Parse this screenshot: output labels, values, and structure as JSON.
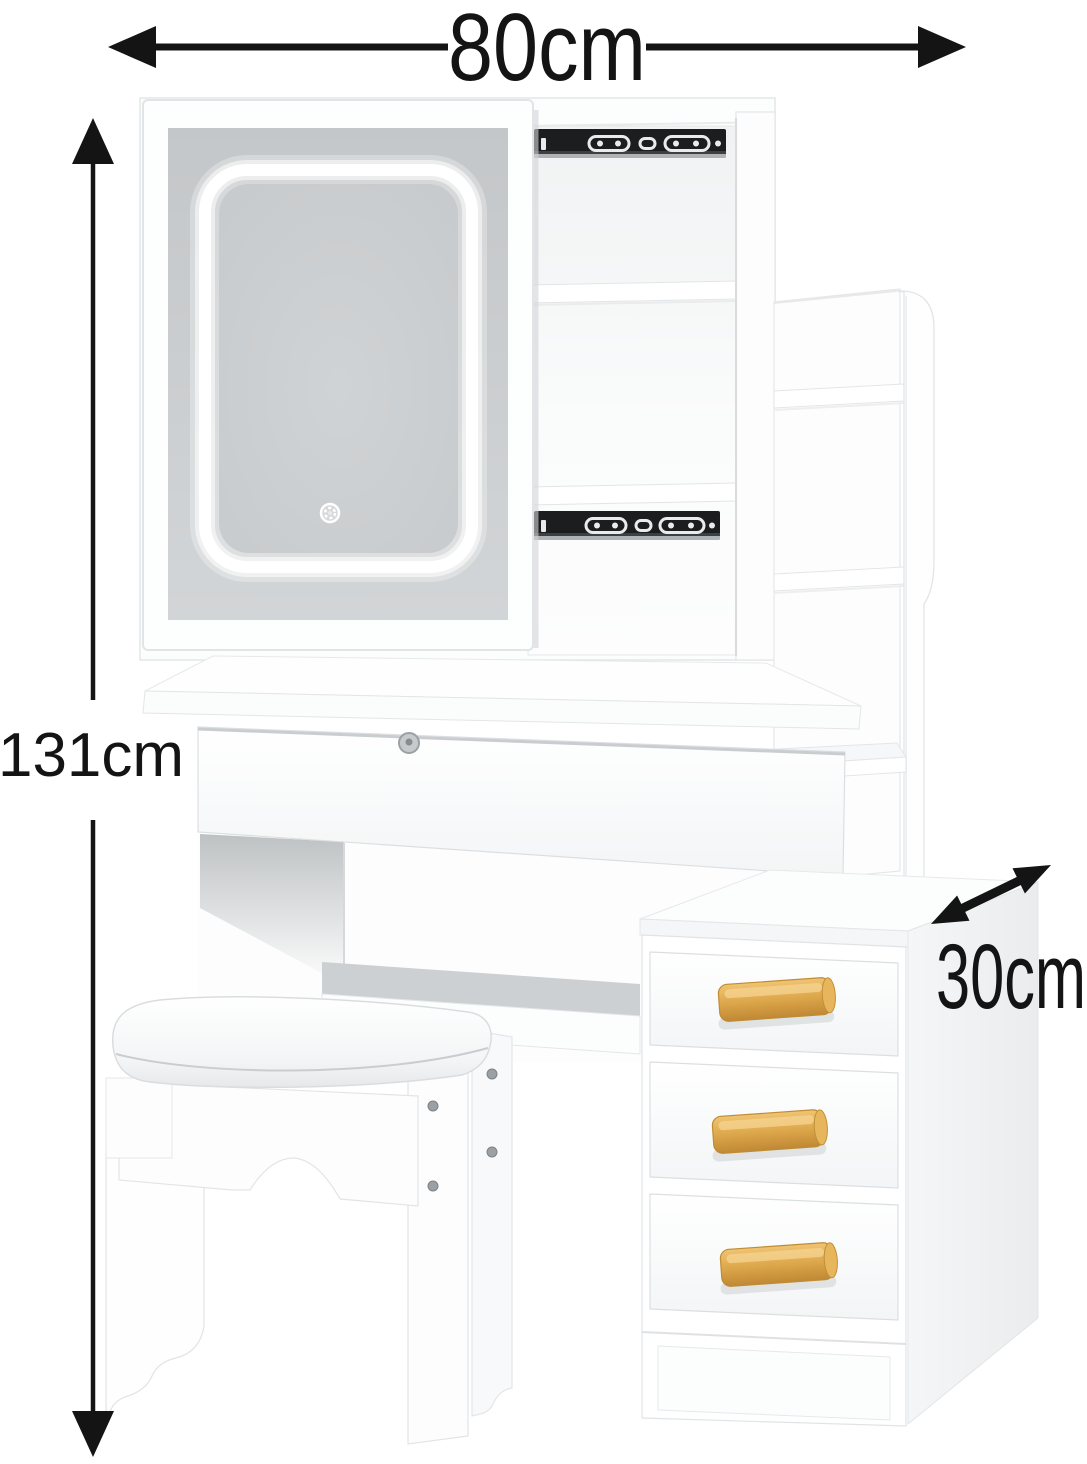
{
  "diagram": {
    "type": "product-dimension-diagram",
    "subject": "Vanity dressing table set with LED mirror, shelf tower, 3-drawer cabinet and stool",
    "dimensions": {
      "width_label": "80cm",
      "height_label": "131cm",
      "depth_label": "30cm"
    },
    "colors": {
      "background": "#ffffff",
      "annotation": "#141414",
      "furniture_white": "#ffffff",
      "panel_edge": "#e3e6e8",
      "mirror_glass": "#c9cccf",
      "led_ring": "#ffffff",
      "drawer_slide_black": "#1b1d1f",
      "wood_handle": "#dca44a",
      "shadow_gray": "#c9cdd0",
      "screw": "#9aa0a4"
    },
    "parts": [
      "led-mirror",
      "touch-sensor-button",
      "hutch-cubbies",
      "drawer-slide-rails",
      "side-shelf-tower",
      "desk-drawer-with-lock",
      "support-stretcher",
      "three-drawer-cabinet",
      "wooden-handles",
      "upholstered-stool"
    ]
  }
}
